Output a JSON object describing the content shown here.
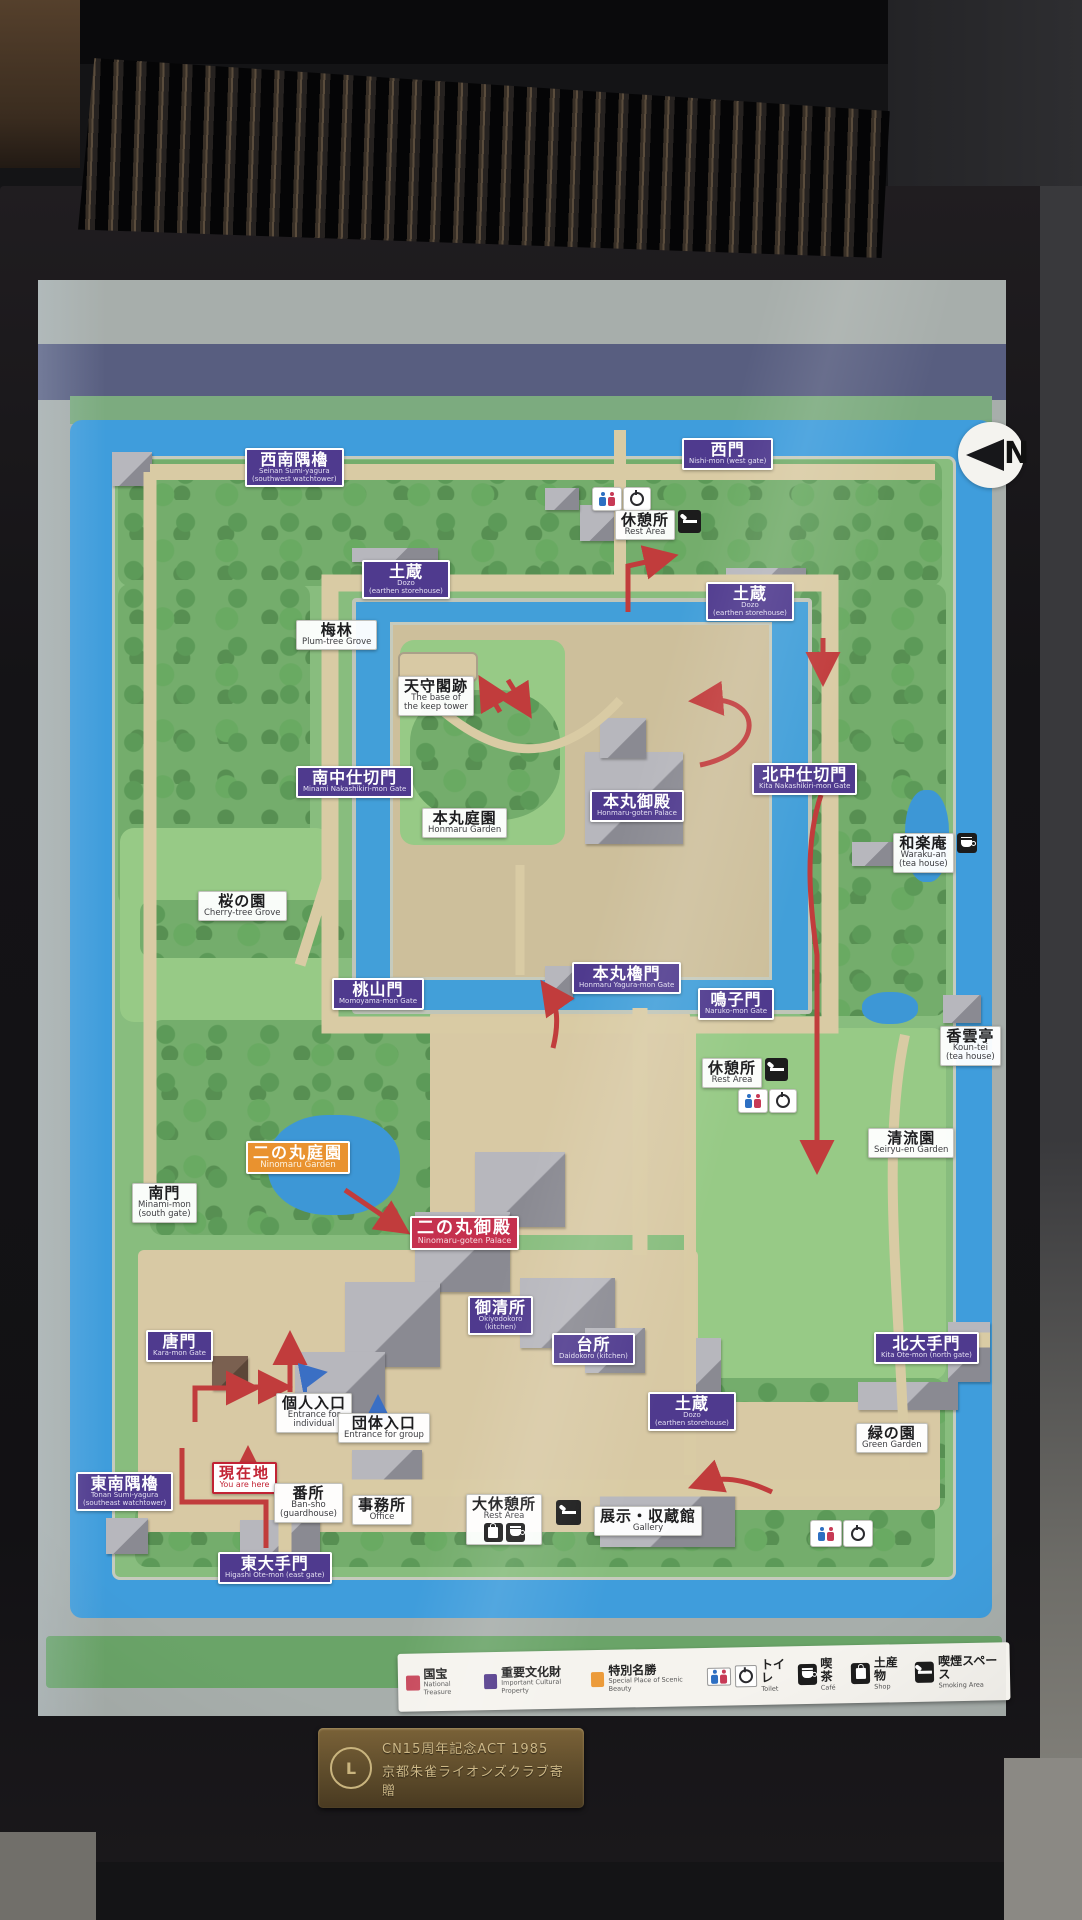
{
  "compass_letter": "N",
  "labels": {
    "seinan_sumi_yagura": {
      "jp": "西南隅櫓",
      "en": "Seinan Sumi-yagura",
      "en2": "(southwest watchtower)"
    },
    "nishi_mon": {
      "jp": "西門",
      "en": "Nishi-mon (west gate)"
    },
    "rest_area_west": {
      "jp": "休憩所",
      "en": "Rest Area"
    },
    "dozo_nw": {
      "jp": "土蔵",
      "en": "Dozo",
      "en2": "(earthen storehouse)"
    },
    "dozo_ne": {
      "jp": "土蔵",
      "en": "Dozo",
      "en2": "(earthen storehouse)"
    },
    "bairin": {
      "jp": "梅林",
      "en": "Plum-tree Grove"
    },
    "tenshukaku_ato": {
      "jp": "天守閣跡",
      "en": "The base of",
      "en2": "the keep tower"
    },
    "minami_nakashikiri_mon": {
      "jp": "南中仕切門",
      "en": "Minami Nakashikiri-mon Gate"
    },
    "honmaru_garden": {
      "jp": "本丸庭園",
      "en": "Honmaru Garden"
    },
    "honmaru_goten": {
      "jp": "本丸御殿",
      "en": "Honmaru-goten Palace"
    },
    "kita_nakashikiri_mon": {
      "jp": "北中仕切門",
      "en": "Kita Nakashikiri-mon Gate"
    },
    "waraku_an": {
      "jp": "和楽庵",
      "en": "Waraku-an",
      "en2": "(tea house)"
    },
    "sakura_no_sono": {
      "jp": "桜の園",
      "en": "Cherry-tree Grove"
    },
    "momoyama_mon": {
      "jp": "桃山門",
      "en": "Momoyama-mon Gate"
    },
    "honmaru_yagura_mon": {
      "jp": "本丸櫓門",
      "en": "Honmaru Yagura-mon Gate"
    },
    "naruko_mon": {
      "jp": "鳴子門",
      "en": "Naruko-mon Gate"
    },
    "koun_tei": {
      "jp": "香雲亭",
      "en": "Koun-tei",
      "en2": "(tea house)"
    },
    "rest_area_mid": {
      "jp": "休憩所",
      "en": "Rest Area"
    },
    "seiryu_en": {
      "jp": "清流園",
      "en": "Seiryu-en Garden"
    },
    "minami_mon": {
      "jp": "南門",
      "en": "Minami-mon",
      "en2": "(south gate)"
    },
    "ninomaru_garden": {
      "jp": "二の丸庭園",
      "en": "Ninomaru Garden"
    },
    "ninomaru_goten": {
      "jp": "二の丸御殿",
      "en": "Ninomaru-goten Palace"
    },
    "okiyodokoro": {
      "jp": "御清所",
      "en": "Okiyodokoro",
      "en2": "(kitchen)"
    },
    "daidokoro": {
      "jp": "台所",
      "en": "Daidokoro (kitchen)"
    },
    "kara_mon": {
      "jp": "唐門",
      "en": "Kara-mon Gate"
    },
    "kojin_iriguchi": {
      "jp": "個人入口",
      "en": "Entrance for",
      "en2": "individual"
    },
    "dantai_iriguchi": {
      "jp": "団体入口",
      "en": "Entrance for group"
    },
    "kita_ote_mon": {
      "jp": "北大手門",
      "en": "Kita Ote-mon (north gate)"
    },
    "dozo_s": {
      "jp": "土蔵",
      "en": "Dozo",
      "en2": "(earthen storehouse)"
    },
    "midori_no_sono": {
      "jp": "緑の園",
      "en": "Green Garden"
    },
    "tonan_sumi_yagura": {
      "jp": "東南隅櫓",
      "en": "Tonan Sumi-yagura",
      "en2": "(southeast watchtower)"
    },
    "genzaichi": {
      "jp": "現在地",
      "en": "You are here"
    },
    "bansho": {
      "jp": "番所",
      "en": "Ban-sho",
      "en2": "(guardhouse)"
    },
    "jimusho": {
      "jp": "事務所",
      "en": "Office"
    },
    "dai_kyukeijo": {
      "jp": "大休憩所",
      "en": "Rest Area"
    },
    "tenji_shuzokan": {
      "jp": "展示・収蔵館",
      "en": "Gallery"
    },
    "higashi_ote_mon": {
      "jp": "東大手門",
      "en": "Higashi Ote-mon (east gate)"
    }
  },
  "legend": {
    "categories": [
      {
        "jp": "国宝",
        "en": "National Treasure",
        "color": "#c84a5d"
      },
      {
        "jp": "重要文化財",
        "en": "Important Cultural Property",
        "color": "#533a8b"
      },
      {
        "jp": "特別名勝",
        "en": "Special Place of Scenic Beauty",
        "color": "#ec9b3a"
      }
    ],
    "facilities": [
      {
        "jp": "トイレ",
        "en": "Toilet"
      },
      {
        "jp": "喫茶",
        "en": "Café"
      },
      {
        "jp": "土産物",
        "en": "Shop"
      },
      {
        "jp": "喫煙スペース",
        "en": "Smoking Area"
      }
    ]
  },
  "plaque": {
    "line1": "CN15周年記念ACT 1985",
    "line2": "京都朱雀ライオンズクラブ寄贈"
  }
}
